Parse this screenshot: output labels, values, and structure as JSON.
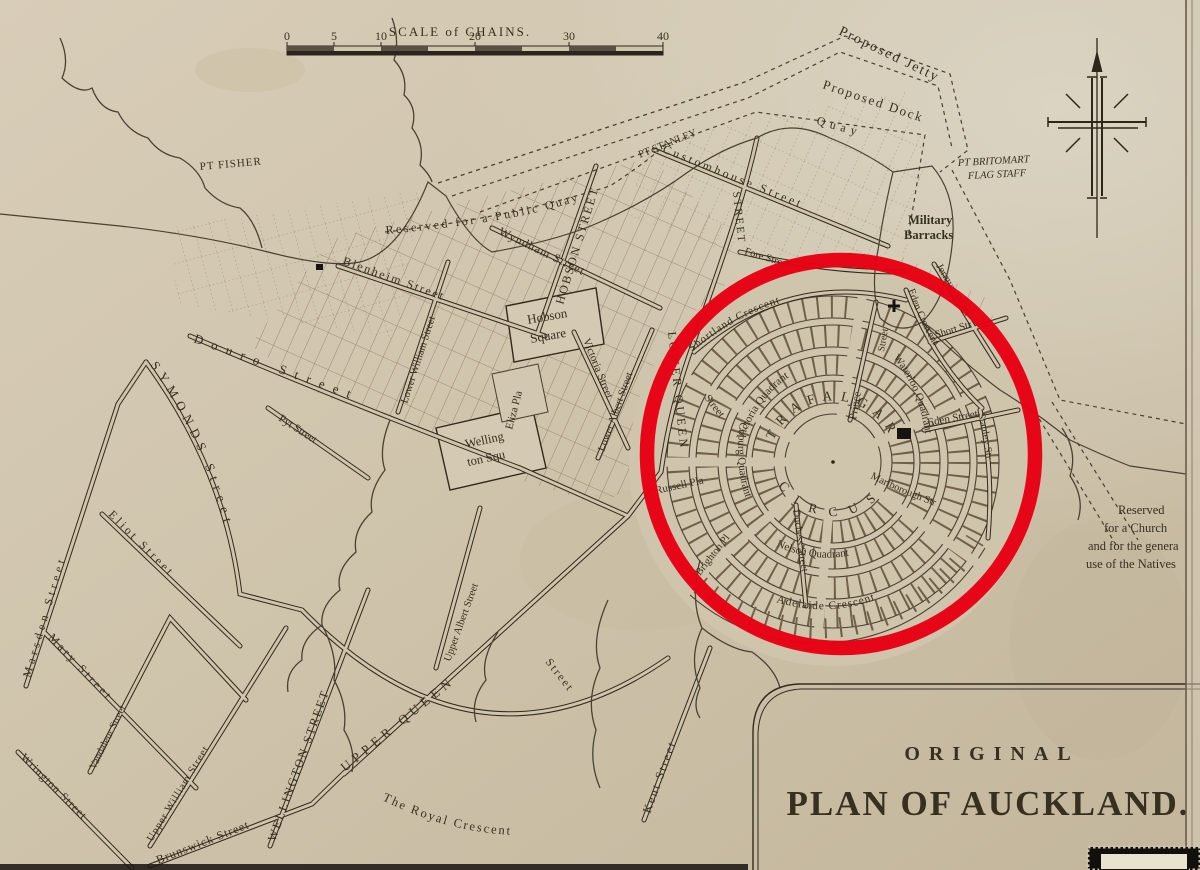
{
  "map": {
    "title": {
      "line1": "ORIGINAL",
      "line2": "PLAN OF AUCKLAND."
    },
    "scale_bar": {
      "title": "SCALE of CHAINS.",
      "ticks": [
        "0",
        "5",
        "10",
        "20",
        "30",
        "40"
      ]
    },
    "compass_icon": "north-compass-cross",
    "colors": {
      "paper": "#cfc4ac",
      "ink": "#37301f",
      "highlight_red": "#e70012"
    },
    "points": {
      "pt_fisher": "PT FISHER",
      "pt_stanley": "PT STANLEY",
      "pt_britomart": [
        "PT BRITOMART",
        "FLAG STAFF"
      ]
    },
    "harbour": {
      "proposed_jetty": "Proposed Jetty",
      "proposed_dock": "Proposed Dock",
      "quay": "Quay",
      "public_quay": "Reserved for a Public Quay"
    },
    "sites": {
      "military_barracks": [
        "Military",
        "Barracks"
      ],
      "hobson_square": [
        "Hobson",
        "Square"
      ],
      "wellington_square": [
        "Welling",
        "ton Squ"
      ],
      "eliza_place": "Eliza Pla",
      "native_reserve": [
        "Reserved",
        "for a Church",
        "and for the genera",
        "use of the Natives"
      ]
    },
    "circus": {
      "top": "TRAFALGAR",
      "bottom": "CIRCUS"
    },
    "streets": {
      "blenheim": "Blenheim Street",
      "wyndham": "Wyndham Street",
      "hobson": "HOBSON STREET",
      "lower_william": "Lower William Street",
      "douro": "Douro Street",
      "victoria": "Victoria Street",
      "lower_albert": "Lower Albert Street",
      "upper_albert": "Upper Albert Street",
      "lower_queen": "LOWER QUEEN",
      "lower_queen_suffix": "Street",
      "queen_north": "STREET",
      "customhouse": "Customhouse Street",
      "fore": "Fore Street",
      "symonds": "SYMONDS Street",
      "marsden": "Marsden Street",
      "eliot": "Eliot Street",
      "mary": "Mary Street",
      "vandaleur": "Vandaleur Street",
      "upper_william": "Upper William Street",
      "wellington": "WELLINGTON STREET",
      "pyt": "Pyt Street",
      "upper_queen": "UPPER QUEEN",
      "upper_queen_suffix": "Street",
      "kent": "Kent Street",
      "royal_crescent": "The Royal Crescent",
      "brunswick": "Brunswick Street",
      "wrington": "Wrington Street",
      "shortland": "Shortland Crescent",
      "eden_crescent": "Eden Crescent",
      "jermyn": "Jermyn Street",
      "short": "Short Str",
      "eden": "Eden Street",
      "stanley": "Stanley Str",
      "prince": "Prince",
      "prince_suffix": "Street",
      "victoria_quadrant": "Victoria Quadrant",
      "waterloo_quadrant": "Waterloo Quadrant",
      "nelson_quadrant": "Nelson Quadrant",
      "coburg_quadrant": "Coburg Quadrant",
      "russell_place": "Russell Pla",
      "brighton_place": "Brighton Pl",
      "duchess": "Duchess Street",
      "adelaide": "Adelaide Crescent",
      "marlborough": "Marlborough Str"
    }
  }
}
